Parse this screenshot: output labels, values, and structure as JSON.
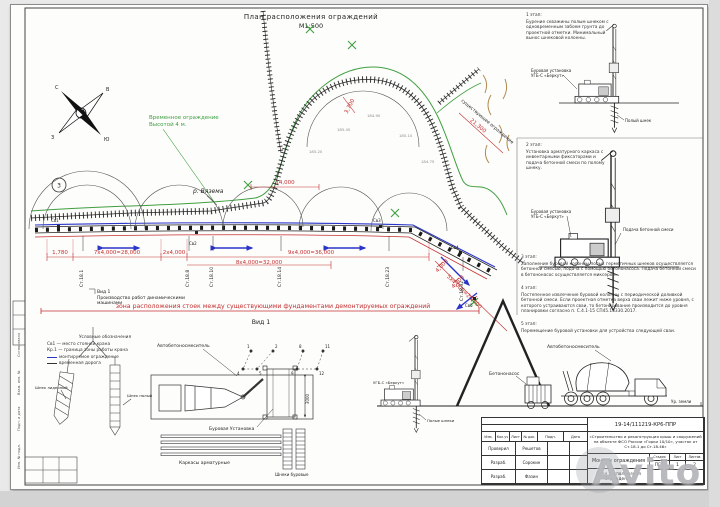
{
  "page": {
    "title": "План расположения ограждений",
    "scale": "М1:500",
    "watermark": "Avito"
  },
  "compass": {
    "n": "С",
    "e": "В",
    "s": "Ю",
    "w": "З"
  },
  "plan": {
    "callout": "3",
    "river": "р. Вязема",
    "temp_fence_1": "Временное ограждение",
    "temp_fence_2": "Высотой 4 м.",
    "existing_fence": "существующее ограждение",
    "zone_note": "зона расположения стоек между существующими фундаментами демонтируемых ограждений",
    "view_ref": "Вид 1",
    "view_note_1": "Производство работ динамическими",
    "view_note_2": "машинами",
    "view_label": "Вид 1",
    "dims": [
      "1,780",
      "7х4,000=28,000",
      "2х4,000",
      "8х4,000=32,000",
      "9х4,000=36,000",
      "4,000",
      "4,000",
      "5х4,000=20,000",
      "14,000",
      "3,700",
      "21,300"
    ],
    "stations": [
      "Ст.18.1",
      "Ст.18.8",
      "Ст.18.10",
      "Ст.18.14",
      "Ст.18.23",
      "Ст.18.32"
    ],
    "crane_points": [
      "Св1",
      "Св2",
      "Св3",
      "Св4",
      "Св5"
    ],
    "elevations": [
      "185.20",
      "185.45",
      "184.90",
      "185.10",
      "184.75"
    ]
  },
  "stages": {
    "s1_title": "1 этап:",
    "s1_text": "Бурение скважины полым шнеком с одновременным забоем грунта до проектной отметки. Минимальный вынос шнековой колонны.",
    "s2_title": "2 этап:",
    "s2_text": "Установка арматурного каркаса с инвентарными фиксаторами и подача бетонной смеси по полому шнеку.",
    "s3_title": "3 этап:",
    "s3_text": "Заполнение буровой колонны полых герметичных шнеков осуществляется бетонной смесью, подача с помощью бетононасоса. Подача бетонной смеси в бетононасос осуществляется миксером.",
    "s4_title": "4 этап:",
    "s4_text": "Постепенное извлечение буровой колонны с периодической доливкой бетонной смеси. Если проектная отметка верха сваи лежит ниже уровня, с которого устраиваются сваи, то бетонирование производится до уровня планировки согласно п. С.4.1-15 СП45.13330.2017.",
    "s5_title": "5 этап:",
    "s5_text": "Перемещение буровой установки для устройства следующей сваи."
  },
  "rig": {
    "label_1": "Буровая установка",
    "label_2": "УГБ-С «Беркут»",
    "auger": "Полый шнек",
    "feed": "Подача бетонной смеси"
  },
  "details": {
    "legend_title": "Условные обозначения",
    "legend_1": "Св1 — место стоянки крана",
    "legend_2": "Кр.1 — граница зоны работы крана",
    "legend_3": "монтируемое ограждение",
    "legend_4": "временная дорога",
    "auger_lead": "Шнек лидерный",
    "auger_hollow": "Шнек полый",
    "mixer_plan": "Автобетоносмеситель",
    "rig_plan": "Буровая Установка",
    "dim_3000": "3000",
    "seq": [
      "1",
      "2",
      "4",
      "5",
      "8",
      "9",
      "11",
      "12"
    ],
    "cages": "Каркасы арматурные",
    "augers": "Шнеки буровые",
    "pump": "Бетононасос",
    "mixer_side": "Автобетоносмеситель",
    "ground": "Ур. земли",
    "rig_side": "УГБ-С «Беркут»",
    "hollow_augers": "Полые шнеки"
  },
  "titleblock": {
    "doc": "19-14/111219-КР6-ППР",
    "object": "«Строительство и реконструкция крыш и сооружений на объекте ФСО России «Горки 10/10», участок от Ст.18.1 до Ст.18.46»",
    "work": "Монтаж ограждения",
    "sheet_name": "План расположения ограждения",
    "h_stage": "Стадия",
    "h_sheet": "Лист",
    "h_sheets": "Листов",
    "stage": "ППР",
    "sheet": "1",
    "sheets": "2",
    "c1": "Изм.",
    "c2": "Кол.уч",
    "c3": "Лист",
    "c4": "№ док.",
    "c5": "Подп.",
    "c6": "Дата",
    "r1_role": "Проверил",
    "r1_name": "Решетов",
    "r2_role": "Разраб.",
    "r2_name": "Сорокин",
    "r3_role": "Разраб.",
    "r3_name": "Фазин"
  },
  "margin": {
    "m1": "Согласовано",
    "m2": "Взам. инв. №",
    "m3": "Подп. и дата",
    "m4": "Инв. № подл."
  }
}
